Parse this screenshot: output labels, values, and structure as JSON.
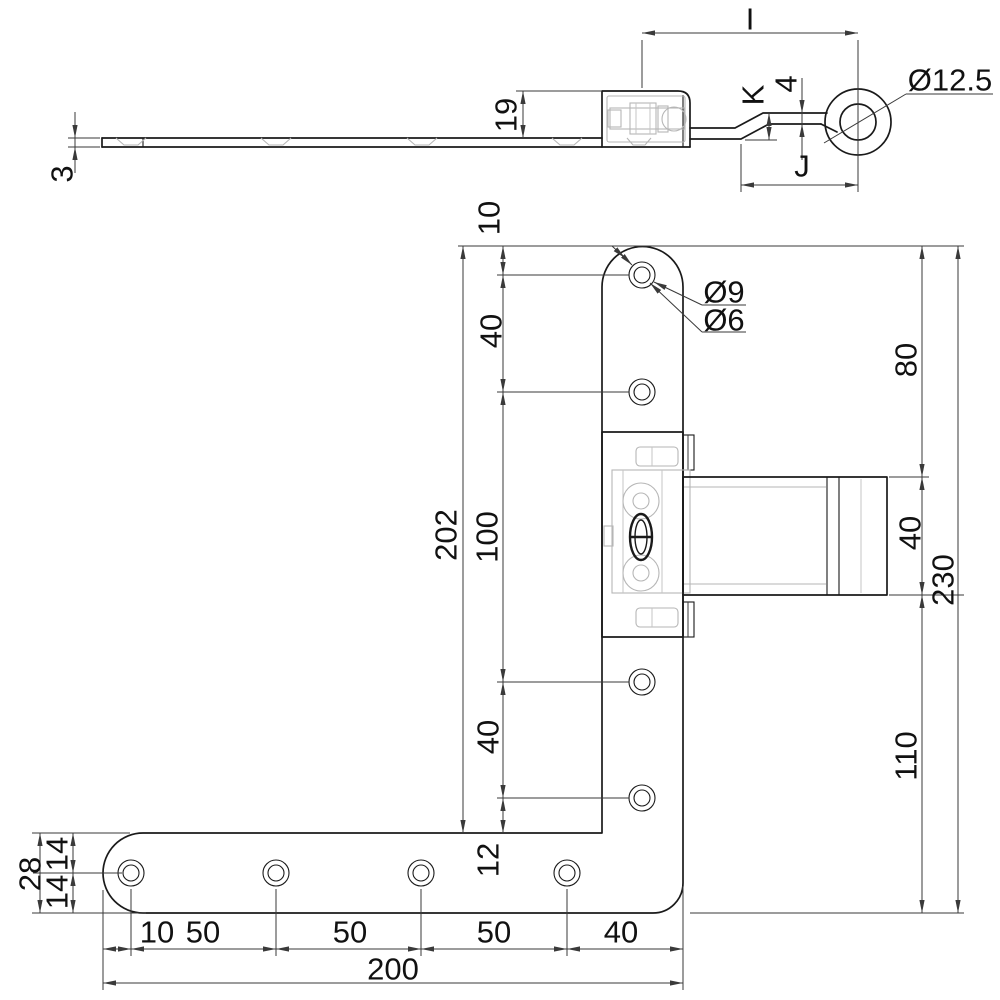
{
  "drawing_type": "technical drawing - cranked hinge with L-shaped strap",
  "colors": {
    "outline": "#1a1a1a",
    "dimension": "#3a3a3a",
    "hidden_detail": "#b6b6b6",
    "background": "#ffffff"
  },
  "side_view": {
    "pivot_to_eye": "I",
    "crank_height": "K",
    "arm_thickness": "4",
    "bend_to_eye": "J",
    "eye_diameter": "Ø12.5",
    "block_height": "19",
    "plate_thickness": "3"
  },
  "front_view": {
    "left_chain": {
      "top_to_hole": "10",
      "upper_pitch": "40",
      "overall": "202",
      "mid_span": "100",
      "lower_pitch": "40",
      "hole_to_bottom": "12"
    },
    "hole_callout": {
      "countersink": "Ø9",
      "bore": "Ø6"
    },
    "right_chain": {
      "top_to_arm": "80",
      "arm_width": "40",
      "overall": "230",
      "arm_to_bottom": "110"
    },
    "end_section": {
      "width": "28",
      "top_half": "14",
      "bottom_half": "14"
    },
    "bottom_chain": {
      "end_to_hole": "10",
      "pitch_1": "50",
      "pitch_2": "50",
      "pitch_3": "50",
      "hole_to_corner": "40",
      "overall": "200"
    }
  }
}
